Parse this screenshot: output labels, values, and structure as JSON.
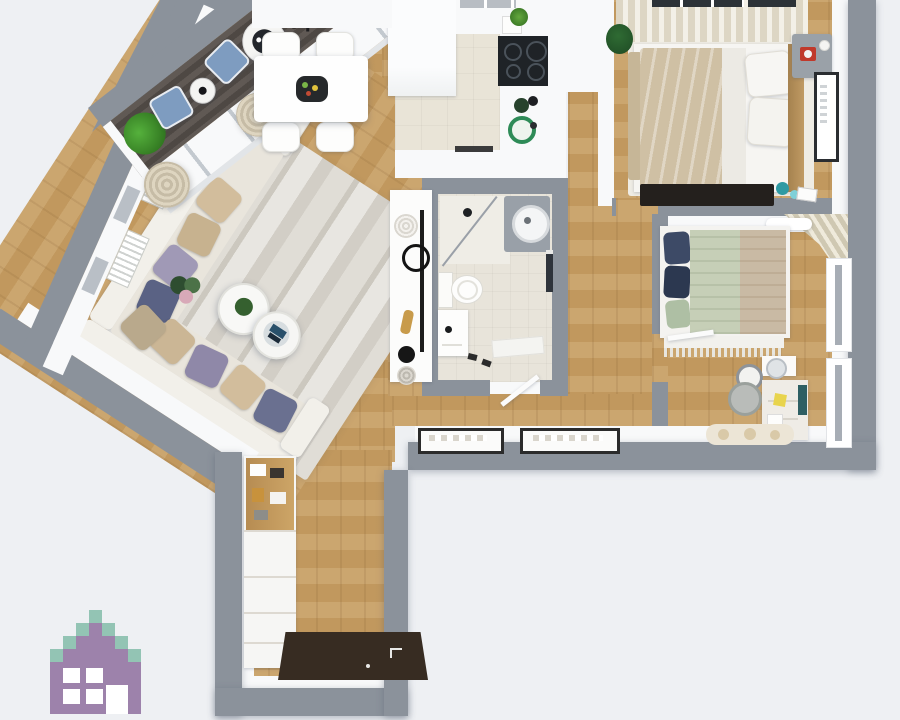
{
  "scene": {
    "description": "Top-down 3D rendered floor plan of a furnished apartment",
    "view": "bird's eye render, no visible text"
  },
  "palette": {
    "bg": "#eef0f3",
    "wall": "#8b929b",
    "wall_inner": "#f8f9fa",
    "wood": "#c79e63",
    "kitchen_floor": "#e9e4d7",
    "bath_floor": "#e8e4da",
    "balcony_floor": "#57504b",
    "rug_living": "#dcd8d0",
    "rug_cream": "#efece4",
    "rug_black": "#24201d",
    "mat_entry": "#372c22",
    "sofa_white": "#f2f0ea",
    "cushion_beige": "#e9e5dc",
    "pillow_beige": "#d2bd9c",
    "pillow_lavender": "#a099b6",
    "pillow_navy": "#5a6284",
    "bed_blanket_beige": "#cfc0a4",
    "bed2_sage": "#c6cfb7",
    "bed2_tan": "#c9baa4",
    "bed2_pillow_navy": "#3d4a66",
    "chair_blue": "#7e9cc0",
    "plant_green": "#3f8f2d",
    "accent_teal": "#2e9aa3",
    "clock_red": "#c0392b",
    "note_yellow": "#e8d44d",
    "cooktop_black": "#1f2327",
    "tray_black": "#26292b",
    "curtain_beige": "#d8cfbb",
    "logo_purple": "#9d82ab",
    "logo_teal": "#93c4b4"
  },
  "rooms": [
    {
      "id": "balcony",
      "label": "Balcony",
      "furniture": [
        "green plant",
        "two blue lounge chairs",
        "side table",
        "round table with tray",
        "slatted bench"
      ]
    },
    {
      "id": "living-room",
      "label": "Living room",
      "furniture": [
        "L-shaped corner sofa",
        "throw pillows",
        "striped area rug",
        "two round coffee tables",
        "flower bouquet",
        "rolled curtains",
        "wall radiators"
      ]
    },
    {
      "id": "dining-area",
      "label": "Dining area",
      "furniture": [
        "white dining table",
        "four white chairs",
        "dark serving tray with food"
      ]
    },
    {
      "id": "kitchen",
      "label": "Kitchen",
      "furniture": [
        "white cabinets",
        "black cooktop",
        "counter with green dishes",
        "small plant"
      ]
    },
    {
      "id": "bathroom",
      "label": "Bathroom",
      "furniture": [
        "corner shower with glass panel",
        "washing machine",
        "toilet",
        "vanity sink",
        "bath mat",
        "slippers",
        "door leaf"
      ]
    },
    {
      "id": "bedroom-1",
      "label": "Bedroom 1",
      "furniture": [
        "double bed with beige blanket",
        "two pillows",
        "wood headboard",
        "nightstand with red alarm clock",
        "wall picture",
        "black rug",
        "window curtains",
        "plant"
      ]
    },
    {
      "id": "bedroom-2",
      "label": "Bedroom 2",
      "furniture": [
        "bed with sage and tan bedding",
        "navy pillows",
        "fringed throw",
        "dresser",
        "stool",
        "desk with laptop and sticky note",
        "chair",
        "rug",
        "two windows",
        "corner curtain"
      ]
    },
    {
      "id": "hallway",
      "label": "Hallway / entry",
      "furniture": [
        "console with round mirror",
        "decor objects",
        "wardrobe with shelf unit",
        "dark entry mat",
        "two framed pictures"
      ]
    }
  ],
  "logo": {
    "type": "pixel-art house watermark",
    "colors": [
      "#9d82ab",
      "#93c4b4"
    ],
    "position": "bottom-left"
  }
}
